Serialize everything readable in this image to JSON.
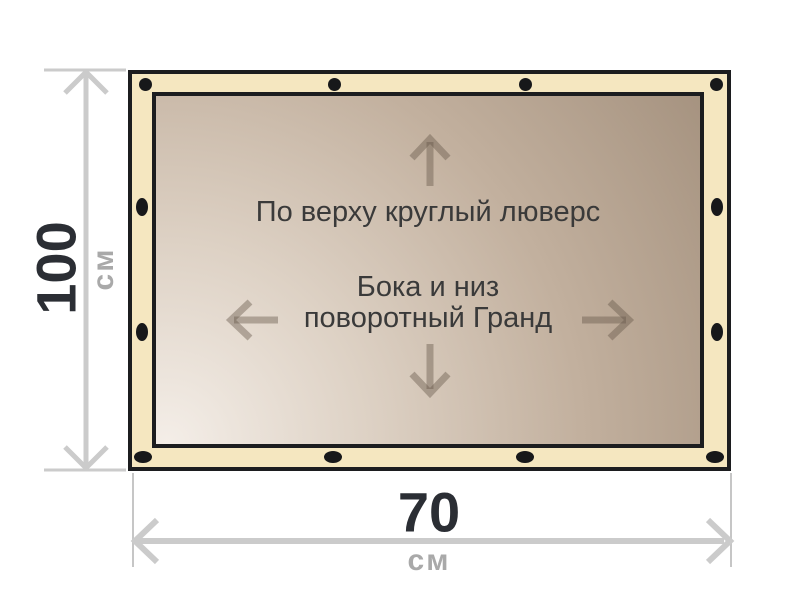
{
  "diagram": {
    "banner": {
      "top_label": "По верху круглый люверс",
      "middle_label_line1": "Бока и низ",
      "middle_label_line2": "поворотный Гранд"
    },
    "dimensions": {
      "height": {
        "value": "100",
        "unit": "см"
      },
      "width": {
        "value": "70",
        "unit": "см"
      }
    },
    "colors": {
      "frame_fill": "#f5e7c0",
      "outline": "#1c1d1f",
      "grommet": "#17181a",
      "dimension_line": "#cbcbcb",
      "value_text": "#2b2e34",
      "unit_text": "#a9a9a9",
      "label_text": "#3a3a3a",
      "direction_arrow": "#9b8d7e",
      "canvas_gradient_start": "#f4eee8",
      "canvas_gradient_end": "#a69380"
    }
  }
}
